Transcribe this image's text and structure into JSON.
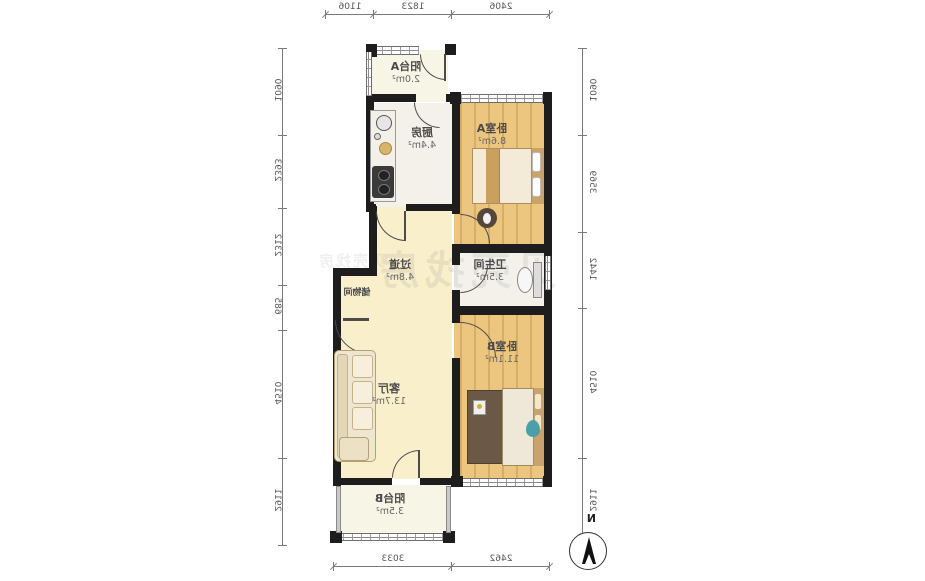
{
  "plan": {
    "rooms": [
      {
        "name": "阳台A",
        "area": "2.0m²"
      },
      {
        "name": "厨房",
        "area": "4.4m²"
      },
      {
        "name": "卧室A",
        "area": "8.6m²"
      },
      {
        "name": "过道",
        "area": "4.8m²"
      },
      {
        "name": "卫生间",
        "area": "3.5m²"
      },
      {
        "name": "储物间",
        "area": ""
      },
      {
        "name": "客厅",
        "area": "13.7m²"
      },
      {
        "name": "卧室B",
        "area": "11.1m²"
      },
      {
        "name": "阳台B",
        "area": "3.5m²"
      }
    ],
    "dims": {
      "top": [
        "2406",
        "1823",
        "1106"
      ],
      "bottom": [
        "2462",
        "3033"
      ],
      "left": [
        "1090",
        "3569",
        "1442",
        "4510",
        "2911"
      ],
      "right": [
        "1090",
        "2393",
        "2312",
        "685",
        "4510",
        "2911"
      ]
    },
    "compass": {
      "label": "N"
    },
    "watermark": {
      "text": "贝壳找房"
    },
    "colors": {
      "wall": "#1d1d1d",
      "wood_floor": "#ecc67f",
      "hall_floor": "#f9efcb",
      "teal_accent": "#4aa0a8"
    }
  }
}
